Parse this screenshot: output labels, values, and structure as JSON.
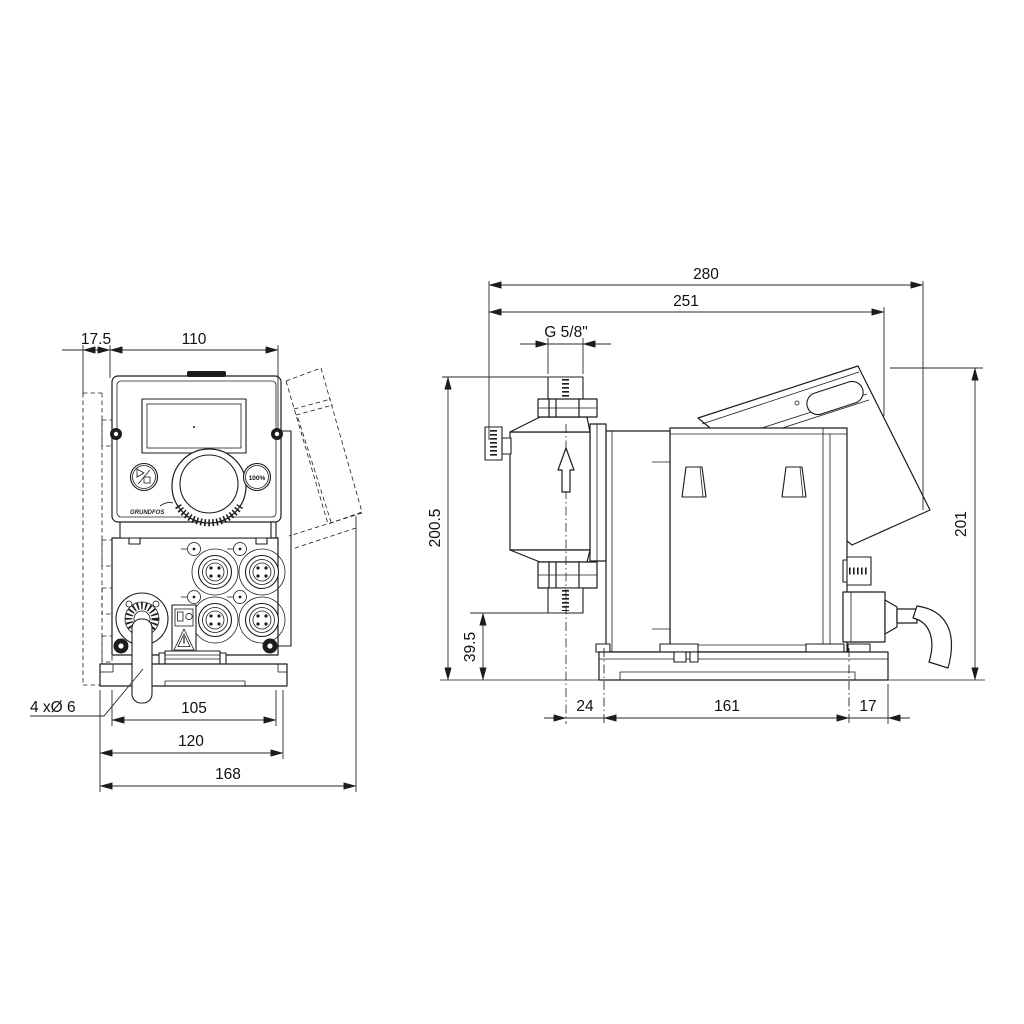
{
  "drawing": {
    "type": "technical-dimensional-drawing",
    "subject": "dosing pump, front and side views",
    "units": "mm",
    "line_color": "#1c1c1c",
    "background": "#ffffff"
  },
  "dims": {
    "wall_offset": "17.5",
    "panel_width": "110",
    "hole_spacing": "105",
    "plate_width": "120",
    "overall_width": "168",
    "mounting_holes": "4 xØ 6",
    "overall_depth": "280",
    "depth_to_rear": "251",
    "thread": "G 5/8\"",
    "overall_height": "200.5",
    "valve_height": "39.5",
    "head_offset": "24",
    "plate_length": "161",
    "rear_offset": "17",
    "rear_height": "201"
  },
  "controls": {
    "capacity": "100%",
    "brand": "GRUNDFOS"
  }
}
